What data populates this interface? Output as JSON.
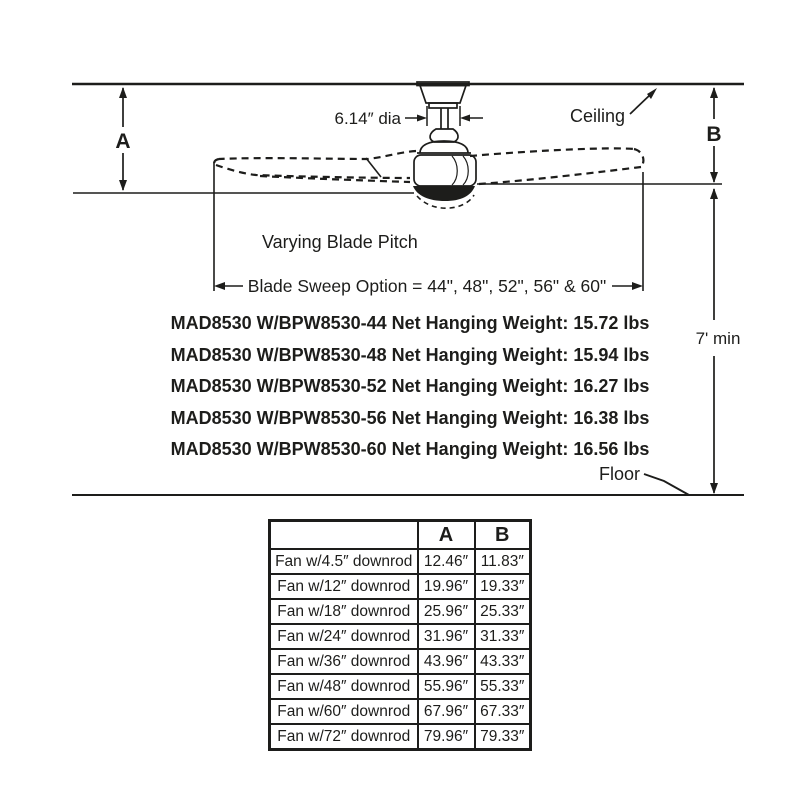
{
  "colors": {
    "ink": "#1d1d1b",
    "paper": "#ffffff"
  },
  "diagram": {
    "dim_a": "A",
    "dim_b": "B",
    "dia_label": "6.14″ dia",
    "ceiling_label": "Ceiling",
    "floor_label": "Floor",
    "min_clearance": "7' min",
    "blade_pitch_note": "Varying Blade Pitch",
    "blade_sweep_note": "Blade Sweep Option = 44\", 48\", 52\", 56\" & 60\"",
    "weights": [
      "MAD8530 W/BPW8530-44 Net Hanging Weight: 15.72 lbs",
      "MAD8530 W/BPW8530-48 Net Hanging Weight: 15.94 lbs",
      "MAD8530 W/BPW8530-52 Net Hanging Weight: 16.27 lbs",
      "MAD8530 W/BPW8530-56 Net Hanging Weight: 16.38 lbs",
      "MAD8530 W/BPW8530-60 Net Hanging Weight: 16.56 lbs"
    ]
  },
  "table": {
    "col_blank": "",
    "col_a": "A",
    "col_b": "B",
    "rows": [
      {
        "label": "Fan w/4.5″ downrod",
        "a": "12.46″",
        "b": "11.83″"
      },
      {
        "label": "Fan w/12″ downrod",
        "a": "19.96″",
        "b": "19.33″"
      },
      {
        "label": "Fan w/18″ downrod",
        "a": "25.96″",
        "b": "25.33″"
      },
      {
        "label": "Fan w/24″ downrod",
        "a": "31.96″",
        "b": "31.33″"
      },
      {
        "label": "Fan w/36″ downrod",
        "a": "43.96″",
        "b": "43.33″"
      },
      {
        "label": "Fan w/48″ downrod",
        "a": "55.96″",
        "b": "55.33″"
      },
      {
        "label": "Fan w/60″ downrod",
        "a": "67.96″",
        "b": "67.33″"
      },
      {
        "label": "Fan w/72″ downrod",
        "a": "79.96″",
        "b": "79.33″"
      }
    ]
  }
}
